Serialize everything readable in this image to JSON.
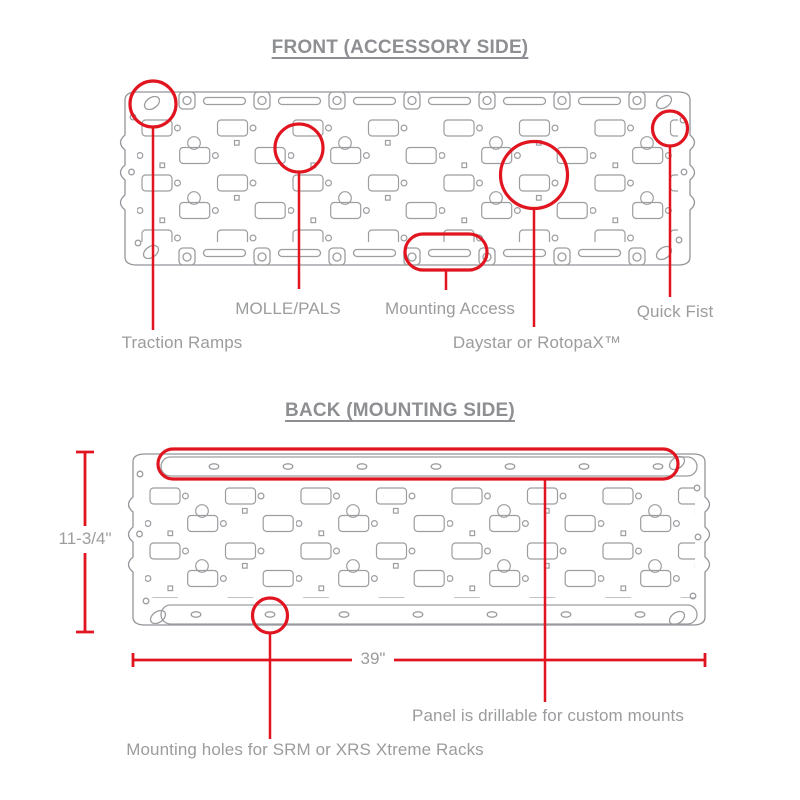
{
  "front": {
    "title": "FRONT (ACCESSORY SIDE)",
    "labels": {
      "molle_pals": "MOLLE/PALS",
      "mounting_access": "Mounting Access",
      "quick_fist": "Quick Fist",
      "traction_ramps": "Traction Ramps",
      "daystar_rotopax": "Daystar or RotopaX™"
    }
  },
  "back": {
    "title": "BACK (MOUNTING SIDE)",
    "labels": {
      "drillable": "Panel is drillable for custom mounts",
      "srm_xrs": "Mounting holes for SRM or XRS Xtreme Racks"
    },
    "dimensions": {
      "panel_height": "11-3/4\"",
      "panel_width": "39\""
    }
  },
  "colors": {
    "annotation_red": "#e11520",
    "label_gray": "#9b9c9e",
    "title_gray": "#8e8f92",
    "line_gray": "#9c9da0",
    "background": "#ffffff"
  }
}
